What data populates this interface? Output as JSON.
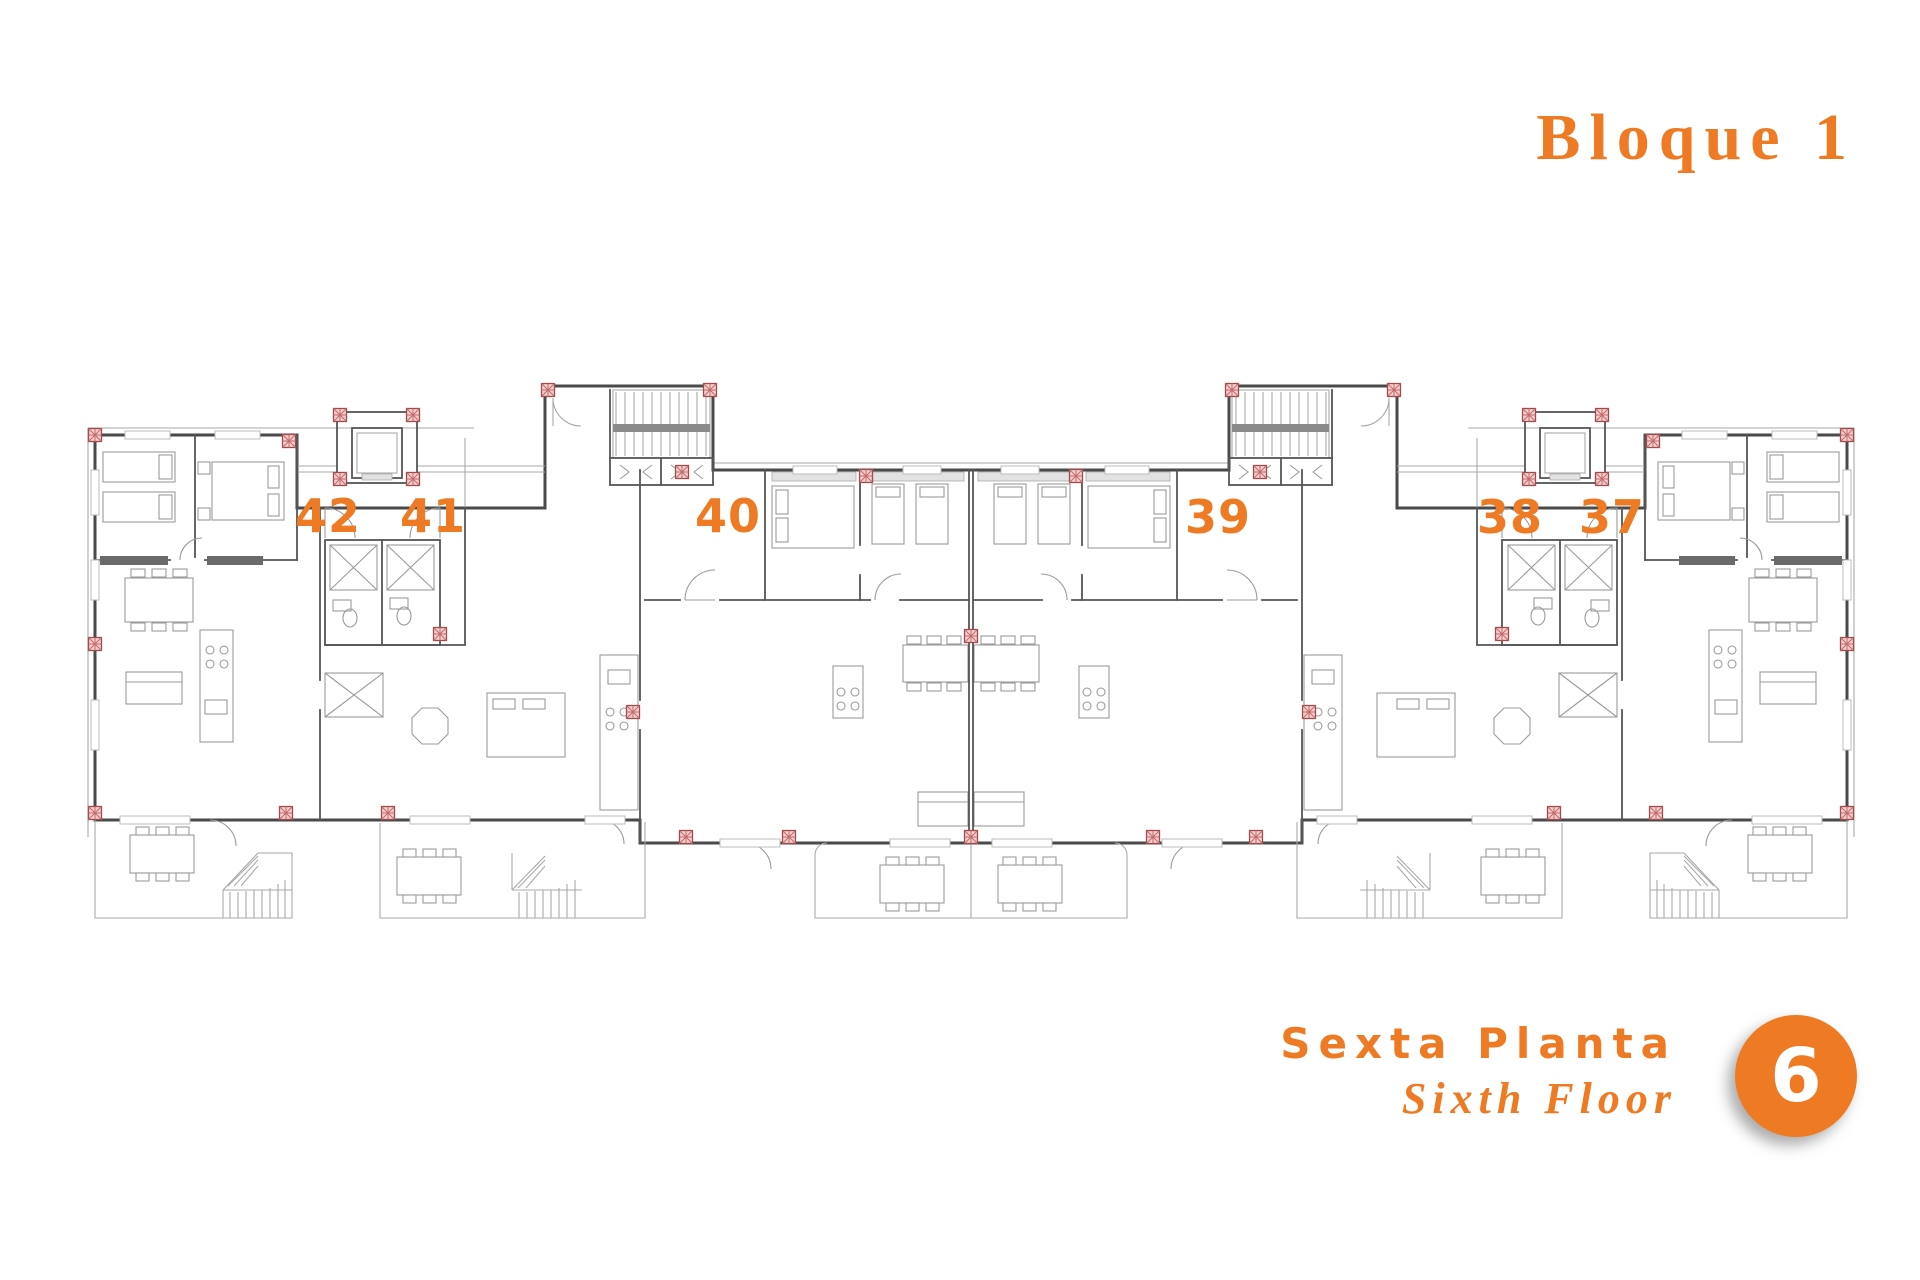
{
  "block": {
    "title": "Bloque 1"
  },
  "apartments": [
    "42",
    "41",
    "40",
    "39",
    "38",
    "37"
  ],
  "floor": {
    "label_es": "Sexta Planta",
    "label_en": "Sixth Floor",
    "number": "6"
  },
  "colors": {
    "accent": "#ee7a23",
    "badge_text": "#ffffff",
    "wall": "#4a4a4a",
    "line": "#9b9b9b",
    "column_red": "#b05050"
  }
}
